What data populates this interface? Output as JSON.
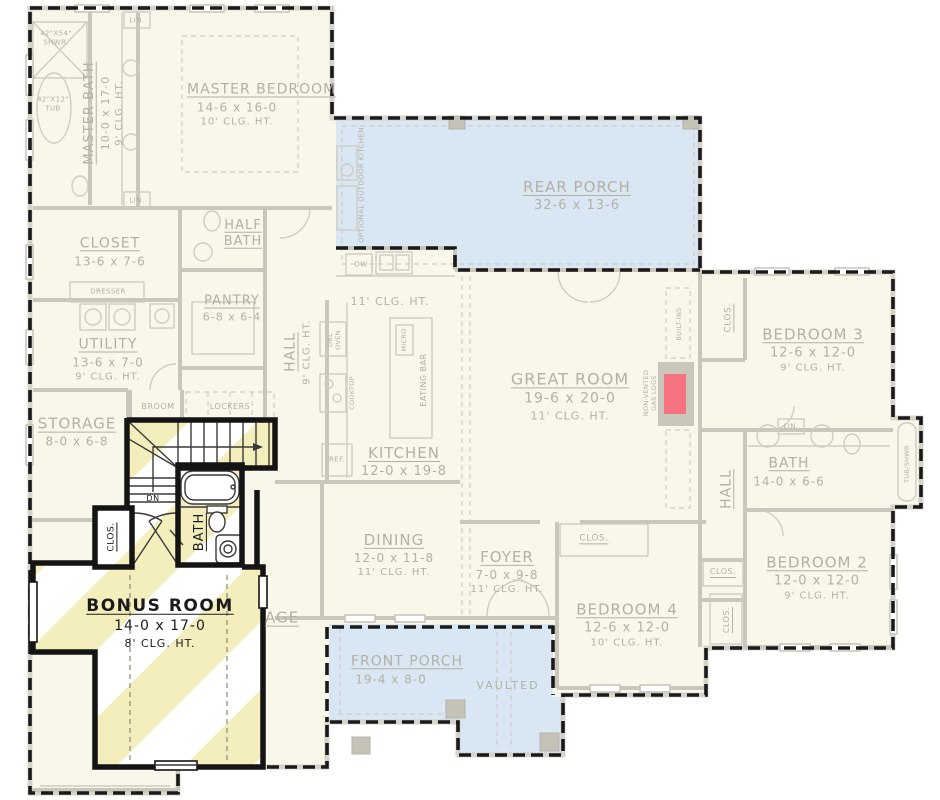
{
  "colors": {
    "porch_blue": "#d9e7f5",
    "highlight_yellow": "#f4eebd",
    "fireplace_red": "#f4737f",
    "faded_wall": "#c9c6bc",
    "faded_text": "#b4b0a3",
    "dark_wall": "#141414",
    "room_fill": "#f9f6ea"
  },
  "rooms": {
    "master_bath": {
      "name": "MASTER BATH",
      "dims": "10-0 x 17-0",
      "clg": "9' CLG. HT."
    },
    "master_bedroom": {
      "name": "MASTER BEDROOM",
      "dims": "14-6 x 16-0",
      "clg": "10' CLG. HT."
    },
    "rear_porch": {
      "name": "REAR PORCH",
      "dims": "32-6 x 13-6"
    },
    "closet": {
      "name": "CLOSET",
      "dims": "13-6 x 7-6"
    },
    "half_bath": {
      "name": "HALF BATH"
    },
    "pantry": {
      "name": "PANTRY",
      "dims": "6-8 x 6-4"
    },
    "utility": {
      "name": "UTILITY",
      "dims": "13-6 x 7-0",
      "clg": "9' CLG. HT."
    },
    "hall_left": {
      "name": "HALL",
      "clg": "9' CLG. HT."
    },
    "kitchen": {
      "name": "KITCHEN",
      "dims": "12-0 x 19-8",
      "clg": "11' CLG. HT."
    },
    "great_room": {
      "name": "GREAT ROOM",
      "dims": "19-6 x 20-0",
      "clg": "11' CLG. HT."
    },
    "bedroom3": {
      "name": "BEDROOM 3",
      "dims": "12-6 x 12-0",
      "clg": "9' CLG. HT."
    },
    "bath_main": {
      "name": "BATH",
      "dims": "14-0 x 6-6"
    },
    "hall_right": {
      "name": "HALL"
    },
    "bedroom2": {
      "name": "BEDROOM 2",
      "dims": "12-0 x 12-0",
      "clg": "9' CLG. HT."
    },
    "bedroom4": {
      "name": "BEDROOM 4",
      "dims": "12-6 x 12-0",
      "clg": "10' CLG. HT."
    },
    "dining": {
      "name": "DINING",
      "dims": "12-0 x 11-8",
      "clg": "11' CLG. HT."
    },
    "foyer": {
      "name": "FOYER",
      "dims": "7-0 x 9-8",
      "clg": "11' CLG. HT."
    },
    "front_porch": {
      "name": "FRONT PORCH",
      "dims": "19-4 x 8-0"
    },
    "storage": {
      "name": "STORAGE",
      "dims": "8-0 x 6-8"
    },
    "bonus_room": {
      "name": "BONUS ROOM",
      "dims": "14-0 x 17-0",
      "clg": "8' CLG. HT."
    },
    "bonus_bath": {
      "name": "BATH"
    },
    "garage": {
      "partial": "AGE"
    }
  },
  "labels": {
    "shower": "42\"X54\" SHWR.",
    "tub": "42\"X12\" TUB",
    "lin": "LIN.",
    "dresser": "DRESSER",
    "broom": "BROOM",
    "lockers": "LOCKERS",
    "dw": "DW",
    "ref": "REF.",
    "dbl_oven": "DBL OVEN",
    "micro": "MICRO",
    "cooktop": "COOKTOP",
    "eating_bar": "EATING BAR",
    "optional_outdoor_kitchen": "OPTIONAL OUTDOOR KITCHEN",
    "built_ins": "BUILT-INS",
    "gas_logs": "NON-VENTED GAS LOGS",
    "tub_shwr": "TUB/SHWR",
    "clos": "CLOS.",
    "vaulted": "VAULTED",
    "dn": "DN"
  }
}
